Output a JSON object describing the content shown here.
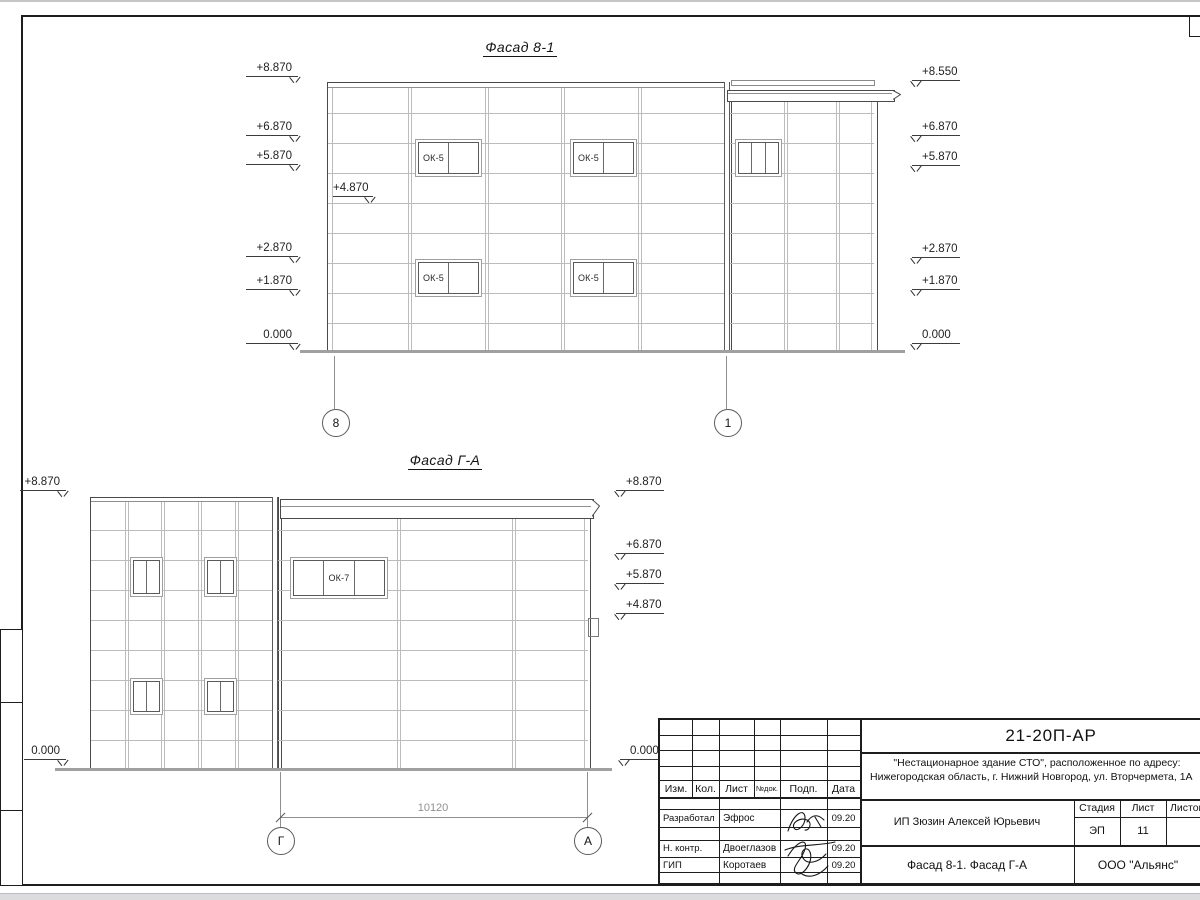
{
  "colors": {
    "outline": "#4a4a4a",
    "joint": "#bcbcbc",
    "ground": "#a0a0a0",
    "text": "#1a1a1a"
  },
  "facade81": {
    "title": "Фасад 8-1",
    "left_marks": [
      "+8.870",
      "+6.870",
      "+5.870",
      "+2.870",
      "+1.870",
      "0.000"
    ],
    "inner_mark": "+4.870",
    "right_marks": [
      "+8.550",
      "+6.870",
      "+5.870",
      "+2.870",
      "+1.870",
      "0.000"
    ],
    "windows": [
      "ОК-5",
      "ОК-5",
      "ОК-5",
      "ОК-5"
    ],
    "axes": [
      "8",
      "1"
    ]
  },
  "facadeGA": {
    "title": "Фасад Г-А",
    "left_marks": [
      "+8.870",
      "0.000"
    ],
    "right_marks": [
      "+8.870",
      "+6.870",
      "+5.870",
      "+4.870",
      "0.000"
    ],
    "window_label": "ОК-7",
    "dimension": "10120",
    "axes": [
      "Г",
      "А"
    ]
  },
  "titleblock": {
    "doc_number": "21-20П-АР",
    "project_line1": "\"Нестационарное здание СТО\", расположенное по адресу:",
    "project_line2": "Нижегородская область, г. Нижний Новгород, ул. Вторчермета, 1А",
    "client": "ИП Зюзин Алексей Юрьевич",
    "sheet_title": "Фасад 8-1. Фасад Г-А",
    "company": "ООО \"Альянс\"",
    "stage_label": "Стадия",
    "sheet_label": "Лист",
    "sheets_label": "Листов",
    "stage_value": "ЭП",
    "sheet_value": "11",
    "headers": [
      "Изм.",
      "Кол.",
      "Лист",
      "№док.",
      "Подп.",
      "Дата"
    ],
    "rows": [
      {
        "role": "Разработал",
        "name": "Эфрос",
        "date": "09.20"
      },
      {
        "role": "Н. контр.",
        "name": "Двоеглазов",
        "date": "09.20"
      },
      {
        "role": "ГИП",
        "name": "Коротаев",
        "date": "09.20"
      }
    ]
  }
}
